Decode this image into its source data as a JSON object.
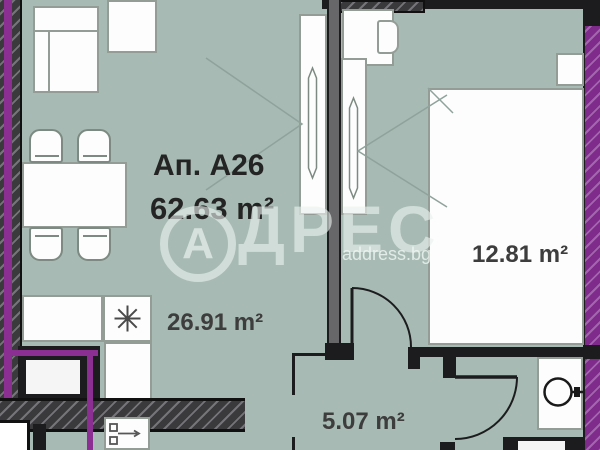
{
  "title": {
    "apartment": "Ап. А26",
    "total_area": "62.63 m²"
  },
  "rooms": {
    "living": {
      "name": "living-room-kitchen",
      "area": "26.91 m²"
    },
    "bedroom": {
      "name": "bedroom",
      "area": "12.81 m²"
    },
    "hallway": {
      "name": "hallway",
      "area": "5.07 m²"
    }
  },
  "watermark": {
    "logo_letter": "А",
    "brand_rest": "ДРЕС",
    "site": "address.bg"
  },
  "colors": {
    "floor": "#a7bab3",
    "wall_dark": "#3a3a3d",
    "insulation_purple": "#8b2f93",
    "watermark": "#eaf2ef",
    "label_text": "#3d3d3d"
  },
  "icons": {
    "stove": "eight-spoke-asterisk",
    "kitchen_faucet": "faucet-with-arrow",
    "washbasin": "circle-basin-with-tap",
    "door_swing": "quarter-arc"
  }
}
